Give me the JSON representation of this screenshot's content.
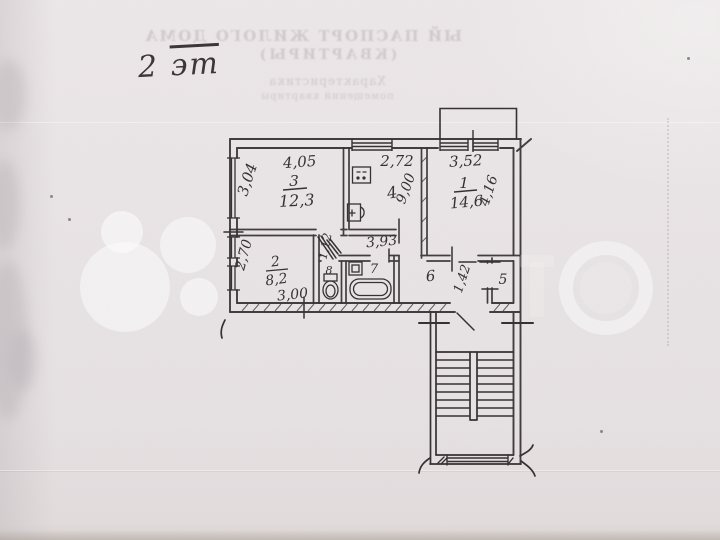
{
  "document": {
    "type_note": "scanned floor plan photo",
    "floor_label": {
      "number": "2",
      "word": "эт"
    }
  },
  "bleedthrough_header": {
    "line1": "ЫЙ ПАСПОРТ ЖИЛОГО ДОМА",
    "line2": "(КВАРТИРЫ)",
    "line3": "Характеристика",
    "line4": "помещений квартиры"
  },
  "plan": {
    "rooms": {
      "room1": {
        "number": "1",
        "area": "14,6",
        "dim_top": "3,52",
        "dim_side": "4,16"
      },
      "room2": {
        "number": "2",
        "area": "8,2",
        "dim_side": "2,70",
        "dim_extra": "3,00"
      },
      "room3": {
        "number": "3",
        "area": "12,3",
        "dim_top": "4,05",
        "dim_side": "3,04"
      },
      "room4": {
        "number": "4",
        "area": "9,00",
        "dim_top": "2,72"
      },
      "room5": {
        "number": "5"
      },
      "room6": {
        "number": "6"
      },
      "room7": {
        "number": "7"
      },
      "room8": {
        "number": "8"
      }
    },
    "dimensions": {
      "corridor_length": "3,93",
      "opening_a": "1,12",
      "opening_b": "1,42"
    }
  },
  "colors": {
    "paper": "#e9e4e5",
    "ink": "#332e30",
    "watermark": "#ffffff"
  }
}
